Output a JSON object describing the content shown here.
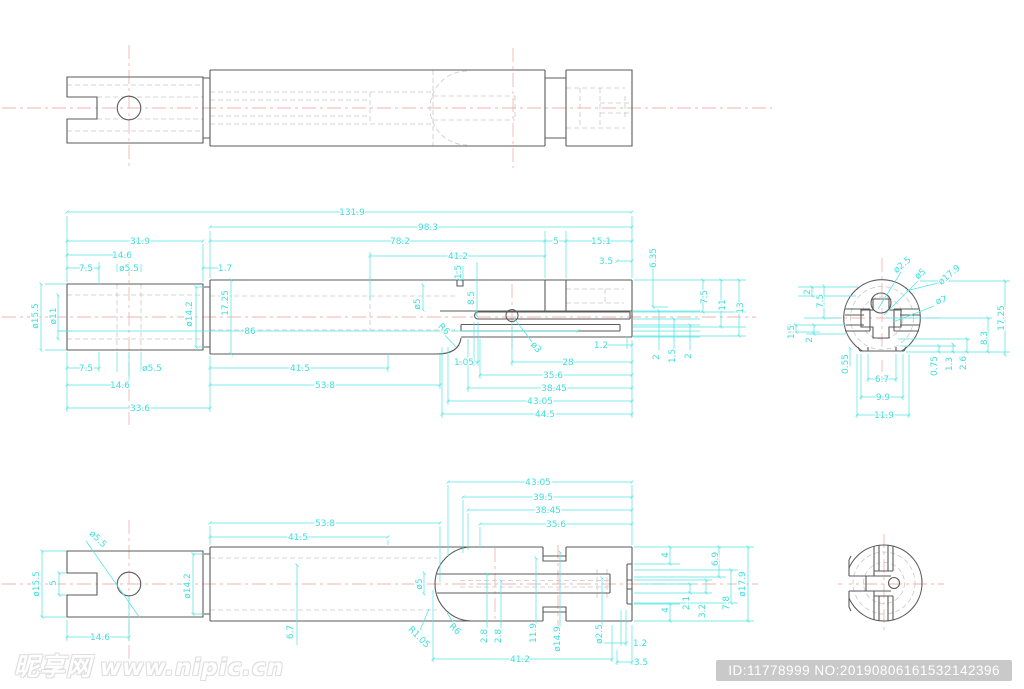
{
  "colors": {
    "dimension_cyan": "#3fdedc",
    "centerline_pink": "#efb6b2",
    "outline_gray": "#5b5b5b",
    "hidden_gray": "#c9c9c9",
    "badge_gray": "#c9c9c9",
    "background": "#ffffff"
  },
  "watermark": {
    "brand": "昵享网",
    "site": "www.nipic.cn"
  },
  "footer_badge": {
    "text": "ID:11778999 NO:20190806161532142396"
  },
  "views": {
    "top_view": {
      "dimensions": []
    },
    "front_section": {
      "dimensions": [
        {
          "t": "131.9",
          "x": 352,
          "y": 215
        },
        {
          "t": "98.3",
          "x": 428,
          "y": 230
        },
        {
          "t": "78.2",
          "x": 400,
          "y": 244
        },
        {
          "t": "5",
          "x": 556,
          "y": 244
        },
        {
          "t": "15.1",
          "x": 601,
          "y": 244
        },
        {
          "t": "31.9",
          "x": 140,
          "y": 244
        },
        {
          "t": "14.6",
          "x": 122,
          "y": 258
        },
        {
          "t": "7.5",
          "x": 86,
          "y": 271
        },
        {
          "t": "ø5.5",
          "x": 129,
          "y": 271
        },
        {
          "t": "1.7",
          "x": 225,
          "y": 271
        },
        {
          "t": "41.2",
          "x": 458,
          "y": 259
        },
        {
          "t": "3.5",
          "x": 606,
          "y": 264
        },
        {
          "t": "1.5",
          "x": 461,
          "y": 272,
          "r": -90
        },
        {
          "t": "6.35",
          "x": 656,
          "y": 258,
          "r": -90
        },
        {
          "t": "ø15.5",
          "x": 38,
          "y": 316,
          "r": -90
        },
        {
          "t": "ø11",
          "x": 56,
          "y": 316,
          "r": -90
        },
        {
          "t": "ø14.2",
          "x": 192,
          "y": 314,
          "r": -90
        },
        {
          "t": "17.25",
          "x": 228,
          "y": 303,
          "r": -90
        },
        {
          "t": "ø5",
          "x": 420,
          "y": 304,
          "r": -90
        },
        {
          "t": "8.5",
          "x": 474,
          "y": 298,
          "r": -90
        },
        {
          "t": "86",
          "x": 250,
          "y": 334
        },
        {
          "t": "ø3",
          "x": 534,
          "y": 349,
          "r": 50
        },
        {
          "t": "R6",
          "x": 442,
          "y": 331,
          "r": 45
        },
        {
          "t": "7.5",
          "x": 86,
          "y": 371
        },
        {
          "t": "ø5.5",
          "x": 152,
          "y": 371
        },
        {
          "t": "41.5",
          "x": 300,
          "y": 371
        },
        {
          "t": "14.6",
          "x": 120,
          "y": 388
        },
        {
          "t": "53.8",
          "x": 325,
          "y": 388
        },
        {
          "t": "33.6",
          "x": 140,
          "y": 411
        },
        {
          "t": "1.05",
          "x": 464,
          "y": 365
        },
        {
          "t": "28",
          "x": 568,
          "y": 365
        },
        {
          "t": "1.2",
          "x": 601,
          "y": 348
        },
        {
          "t": "35.6",
          "x": 553,
          "y": 378
        },
        {
          "t": "38.45",
          "x": 554,
          "y": 391
        },
        {
          "t": "43.05",
          "x": 540,
          "y": 404
        },
        {
          "t": "44.5",
          "x": 545,
          "y": 417
        },
        {
          "t": "2",
          "x": 659,
          "y": 357,
          "r": -90
        },
        {
          "t": "1.5",
          "x": 675,
          "y": 356,
          "r": -90
        },
        {
          "t": "2",
          "x": 691,
          "y": 356,
          "r": -90
        },
        {
          "t": "7.5",
          "x": 707,
          "y": 297,
          "r": -90
        },
        {
          "t": "11",
          "x": 725,
          "y": 305,
          "r": -90
        },
        {
          "t": "13",
          "x": 743,
          "y": 308,
          "r": -90
        }
      ]
    },
    "side_section": {
      "dimensions": [
        {
          "t": "ø2.5",
          "x": 904,
          "y": 267,
          "r": -40
        },
        {
          "t": "ø5",
          "x": 922,
          "y": 276,
          "r": -40
        },
        {
          "t": "ø17.9",
          "x": 951,
          "y": 277,
          "r": -40
        },
        {
          "t": "ø7",
          "x": 942,
          "y": 303,
          "r": -14
        },
        {
          "t": "2",
          "x": 810,
          "y": 292,
          "r": -90
        },
        {
          "t": "7.5",
          "x": 823,
          "y": 301,
          "r": -90
        },
        {
          "t": "1.5",
          "x": 794,
          "y": 332,
          "r": -90
        },
        {
          "t": "2",
          "x": 812,
          "y": 340,
          "r": -90
        },
        {
          "t": "0.55",
          "x": 848,
          "y": 364,
          "r": -90
        },
        {
          "t": "6.7",
          "x": 882,
          "y": 382
        },
        {
          "t": "9.9",
          "x": 883,
          "y": 400
        },
        {
          "t": "11.9",
          "x": 884,
          "y": 418
        },
        {
          "t": "0.75",
          "x": 937,
          "y": 366,
          "r": -90
        },
        {
          "t": "1.3",
          "x": 952,
          "y": 364,
          "r": -90
        },
        {
          "t": "2.6",
          "x": 966,
          "y": 363,
          "r": -90
        },
        {
          "t": "8.3",
          "x": 987,
          "y": 338,
          "r": -90
        },
        {
          "t": "17.25",
          "x": 1004,
          "y": 318,
          "r": -90
        }
      ]
    },
    "bottom_view": {
      "dimensions": [
        {
          "t": "53.8",
          "x": 325,
          "y": 526
        },
        {
          "t": "41.5",
          "x": 298,
          "y": 540
        },
        {
          "t": "43.05",
          "x": 538,
          "y": 485
        },
        {
          "t": "39.5",
          "x": 543,
          "y": 500
        },
        {
          "t": "38.45",
          "x": 548,
          "y": 513
        },
        {
          "t": "35.6",
          "x": 556,
          "y": 527
        },
        {
          "t": "ø5.5",
          "x": 96,
          "y": 541,
          "r": 45
        },
        {
          "t": "ø15.5",
          "x": 39,
          "y": 584,
          "r": -90
        },
        {
          "t": "5",
          "x": 56,
          "y": 583,
          "r": -90
        },
        {
          "t": "ø14.2",
          "x": 190,
          "y": 586,
          "r": -90
        },
        {
          "t": "14.6",
          "x": 100,
          "y": 640
        },
        {
          "t": "6.7",
          "x": 293,
          "y": 632,
          "r": -90
        },
        {
          "t": "ø5",
          "x": 422,
          "y": 584,
          "r": -90
        },
        {
          "t": "R1.05",
          "x": 417,
          "y": 639,
          "r": 45
        },
        {
          "t": "R6",
          "x": 453,
          "y": 631,
          "r": 45
        },
        {
          "t": "2.8",
          "x": 487,
          "y": 636,
          "r": -90
        },
        {
          "t": "2.8",
          "x": 501,
          "y": 636,
          "r": -90
        },
        {
          "t": "11.9",
          "x": 536,
          "y": 633,
          "r": -90
        },
        {
          "t": "ø14.9",
          "x": 560,
          "y": 639,
          "r": -90
        },
        {
          "t": "ø2.5",
          "x": 602,
          "y": 634,
          "r": -90
        },
        {
          "t": "1.2",
          "x": 640,
          "y": 646
        },
        {
          "t": "41.2",
          "x": 520,
          "y": 662
        },
        {
          "t": "3.5",
          "x": 641,
          "y": 665
        },
        {
          "t": "4",
          "x": 668,
          "y": 555,
          "r": -90
        },
        {
          "t": "4",
          "x": 668,
          "y": 610,
          "r": -90
        },
        {
          "t": "2.1",
          "x": 689,
          "y": 603,
          "r": -90
        },
        {
          "t": "3.2",
          "x": 705,
          "y": 611,
          "r": -90
        },
        {
          "t": "6.9",
          "x": 718,
          "y": 559,
          "r": -90
        },
        {
          "t": "7.8",
          "x": 729,
          "y": 603,
          "r": -90
        },
        {
          "t": "ø17.9",
          "x": 745,
          "y": 584,
          "r": -90
        }
      ]
    },
    "side_view_bottom": {
      "dimensions": []
    }
  }
}
